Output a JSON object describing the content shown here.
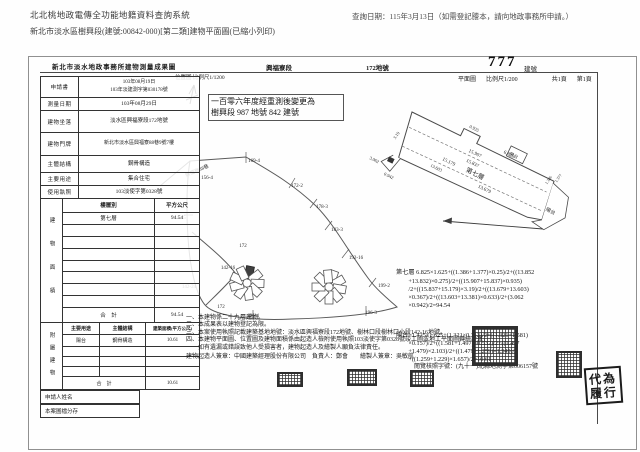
{
  "header": {
    "system_title": "北北桃地政電傳全功能地籍資料查詢系統",
    "query_date": "查詢日期：115年3月13日（如需登記謄本，請向地政事務所申請。）",
    "doc_subtitle": "新北市淡水區樹興段(建號:00842-000)[第二類]建物平面圖(已縮小列印)"
  },
  "doc": {
    "form_title": "新北市淡水地政事務所建物測量成果圖",
    "section": "興福寮段",
    "land_no": "172地號",
    "building_no": "777",
    "building_no_label": "建號",
    "plan_map_label": "平面圖",
    "plan_scale": "比例尺1/200",
    "pages_total": "共1頁",
    "page_current": "第1頁",
    "location_map_label": "位置圖",
    "location_scale": "比例尺1/1200",
    "remark_line1": "一百零六年度經重測後變更為",
    "remark_line2": "樹興段 987 地號 842 建號"
  },
  "form": {
    "rows": [
      {
        "label": "申請書",
        "value": "103年08月19日\n103年淡建測字第030178號"
      },
      {
        "label": "測量日期",
        "value": "103年08月29日"
      },
      {
        "label": "建物坐落",
        "value": "淡水區興福寮段172地號"
      },
      {
        "label": "建物門牌",
        "value": "新北市淡水區興福寮88巷9號7樓"
      },
      {
        "label": "主體結構",
        "value": "鋼骨構造"
      },
      {
        "label": "主要用途",
        "value": "集合住宅"
      },
      {
        "label": "使用執照",
        "value": "103淡使字第0328號"
      }
    ],
    "area": {
      "side_label": "建物面積",
      "col_floor": "樓層別",
      "col_sqm": "平方公尺",
      "floor": "第七層",
      "floor_area": "94.54",
      "total_label": "合　計",
      "total": "94.54"
    },
    "annex": {
      "side_label": "附屬建物",
      "col_use": "主要用途",
      "col_structure": "主體結構",
      "col_area": "建築面積(平方公尺)",
      "use": "陽台",
      "structure": "鋼骨構造",
      "area_value": "10.61",
      "total_label": "合　計",
      "total": "10.61"
    },
    "applicant_label": "申請人姓名",
    "archive_label": "本案圖檔分存"
  },
  "map": {
    "road": "興福寮88巷",
    "parcels": [
      "169-4",
      "172-2",
      "178-3",
      "183-3",
      "192-16",
      "199-2",
      "196-3",
      "196-4",
      "172",
      "142-16",
      "142-24",
      "169-5",
      "156-4",
      "172"
    ]
  },
  "plan": {
    "floor": "第七層",
    "balcony": "陽台",
    "dims": [
      "6.825",
      "15.907",
      "15.837",
      "15.179",
      "13.679",
      "13.603",
      "3.19",
      "0.935",
      "3.062",
      "0.942",
      "1.386",
      "1.377"
    ]
  },
  "calc": {
    "floor": "第七層 6.825×1.625+((1.386+1.377)×0.25)/2+((13.852\n        +13.832)×0.275)/2+((15.907+15.837)×0.935)\n        /2+((15.837+15.179)×3.19)/2+((13.679+13.603)\n        ×0.367)/2+((13.603+13.381)×0.633)/2+(3.062\n        ×0.942)/2=94.54",
    "balcony": "陽台=1.425×1.625+(1.321×0.313)/2+((1.321+1.581)\n        ×0.157)/2+((1.581+1.497)×0.532)/2+((1.497\n        +1.479)×2.103)/2+((1.479+1.259)×1.349)/2\n        +((1.259+1.229)×1.657)/2=10.61"
  },
  "notes": {
    "n1": "一、本建物係二十九層建物。",
    "n2": "二、本成果表以建物登記為限。",
    "n3": "三、本案使用執照記載建築基地地號：淡水區興福寮段172地號、樹林口段樹林口小段142-16地號。",
    "n4": "四、本建物平面圖、位置圖及建物面積係由起造人檢附使用執照103淡使字第0328號竣工圖或地工平面圖轉繪計算，\n　　如有遺漏或錯誤致他人受損害者，建物起造人及繪製人願負法律責任。",
    "builder": "建物起造人簽章：中國建築經理股份有限公司　負責人：鄭會　　繪製人簽章：吳敏航",
    "review": "閱覽核照字號：(九十一)北縣地測字第006157號"
  },
  "stamps": {
    "duty_top": "代為",
    "duty_bottom": "履行"
  }
}
